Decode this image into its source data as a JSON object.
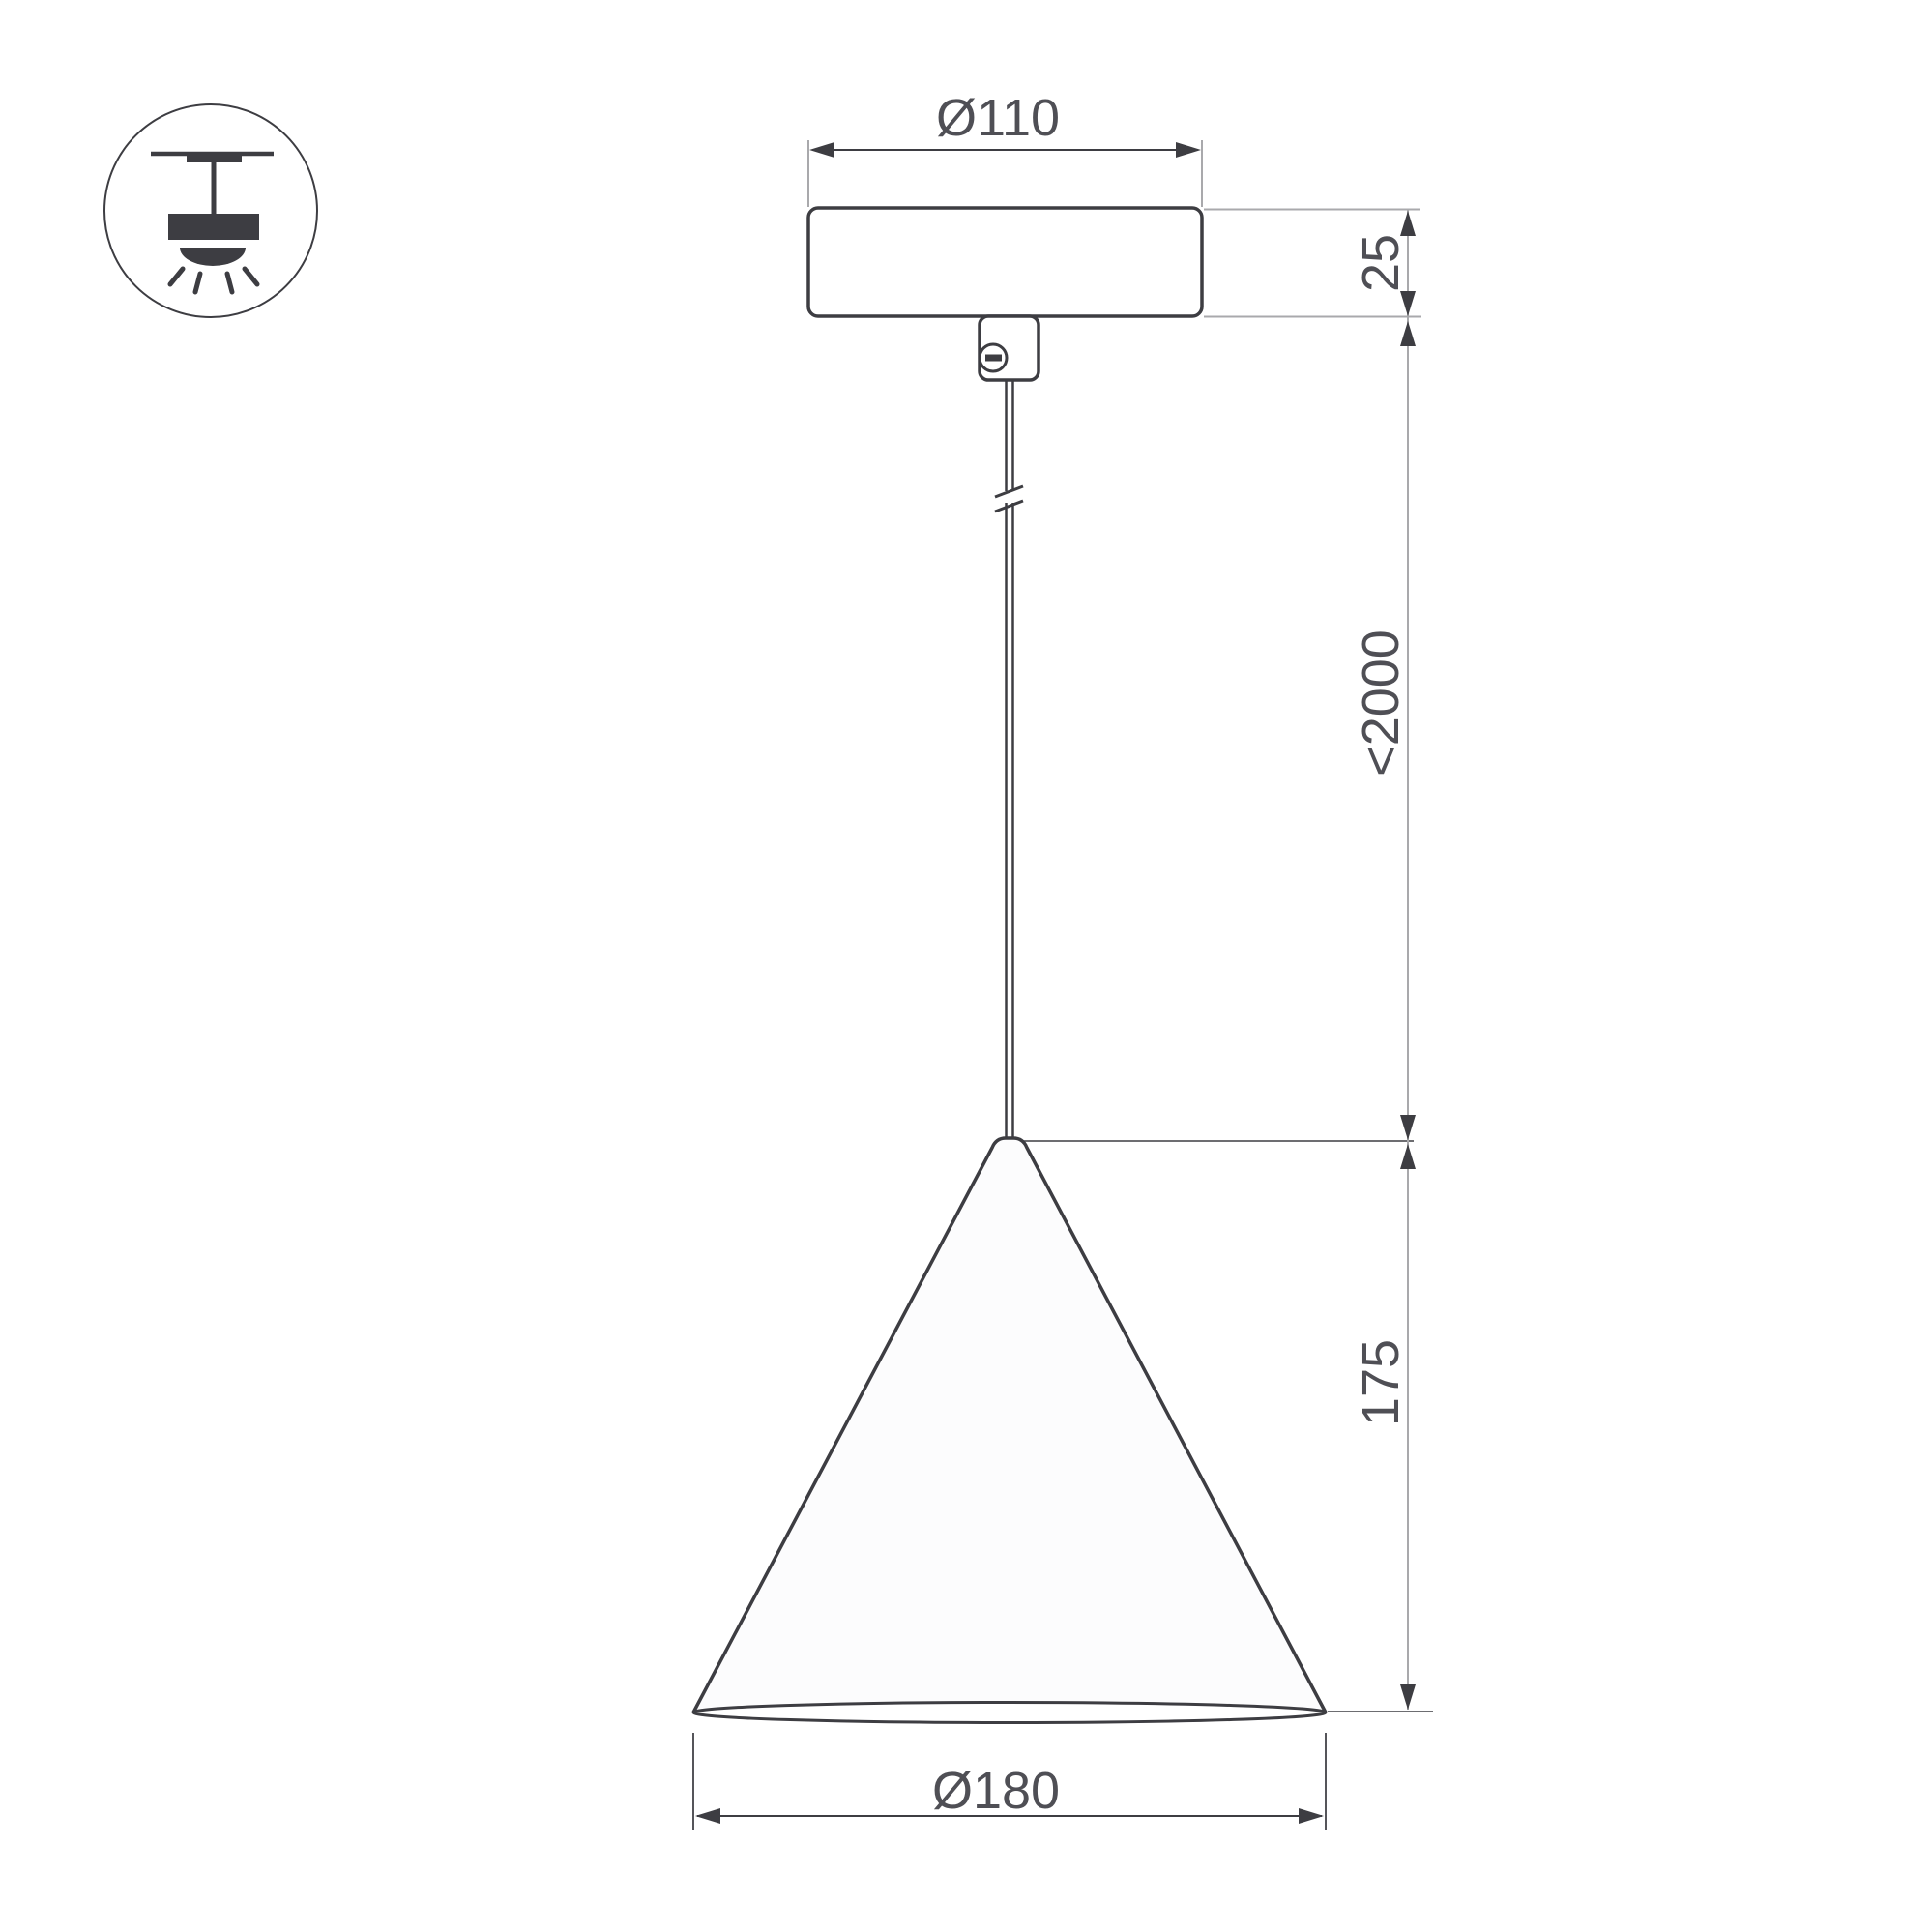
{
  "diagram": {
    "labels": {
      "canopy_diameter": "Ø110",
      "canopy_height": "25",
      "suspension_max_length": "<2000",
      "shade_height": "175",
      "shade_diameter": "Ø180"
    },
    "icons": {
      "mounting": "surface-pendant-mount-icon"
    },
    "colors": {
      "ink": "#3d3d42",
      "text": "#4f4f55",
      "extension_line": "#a9a9ac",
      "background": "#ffffff"
    }
  }
}
